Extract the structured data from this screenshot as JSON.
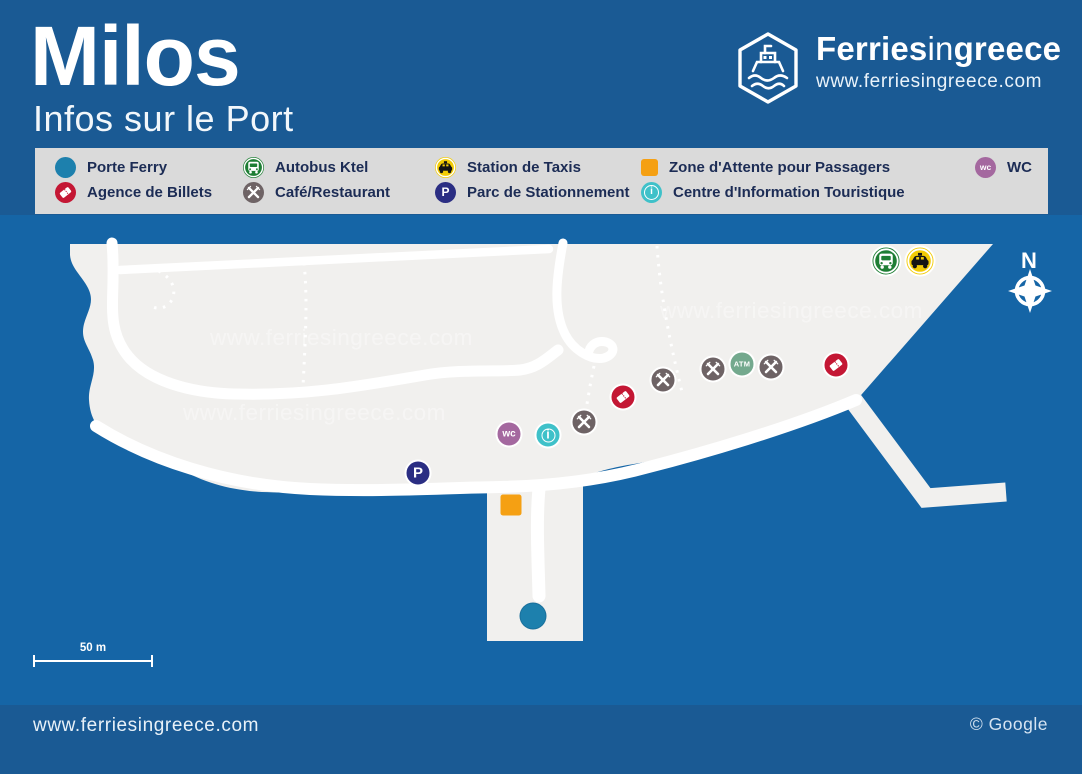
{
  "page": {
    "bg_blue": "#1A5A94",
    "sea_blue": "#1565A6",
    "land_gray": "#F1F0EE",
    "road_white": "#FFFFFF",
    "legend_bg": "#DADADA",
    "legend_text": "#1C2C55"
  },
  "header": {
    "title": "Milos",
    "subtitle": "Infos sur le Port",
    "brand": {
      "part1": "Ferries",
      "part2": "in",
      "part3": "greece",
      "url": "www.ferriesingreece.com"
    }
  },
  "legend": {
    "items": [
      {
        "type": "ferry",
        "label": "Porte Ferry",
        "color": "#1D80AD",
        "row": 0,
        "col": 0
      },
      {
        "type": "bus",
        "label": "Autobus Ktel",
        "color": "#1E7E34",
        "row": 0,
        "col": 1
      },
      {
        "type": "taxi",
        "label": "Station de Taxis",
        "color": "#F2CB05",
        "row": 0,
        "col": 2
      },
      {
        "type": "waiting",
        "label": "Zone d'Attente pour Passagers",
        "color": "#F5A013",
        "shape": "square",
        "row": 0,
        "col": 3
      },
      {
        "type": "wc",
        "label": "WC",
        "color": "#A4689F",
        "text": "wc",
        "row": 0,
        "col": 4
      },
      {
        "type": "ticket",
        "label": "Agence de Billets",
        "color": "#C41734",
        "row": 1,
        "col": 0
      },
      {
        "type": "cafe",
        "label": "Café/Restaurant",
        "color": "#6E6365",
        "row": 1,
        "col": 1
      },
      {
        "type": "parking",
        "label": "Parc de Stationnement",
        "color": "#2B2E83",
        "text": "P",
        "row": 1,
        "col": 2
      },
      {
        "type": "info",
        "label": "Centre d'Information Touristique",
        "color": "#3FC1C9",
        "text": "i",
        "row": 1,
        "col": 3
      }
    ]
  },
  "map": {
    "watermark": "www.ferriesingreece.com",
    "compass_label": "N",
    "scale_label": "50 m",
    "markers": [
      {
        "type": "bus",
        "x": 886,
        "y": 261,
        "color": "#1E7E34"
      },
      {
        "type": "taxi",
        "x": 920,
        "y": 261,
        "color": "#F2CB05"
      },
      {
        "type": "ticket",
        "x": 836,
        "y": 365,
        "color": "#C41734"
      },
      {
        "type": "cafe",
        "x": 771,
        "y": 367,
        "color": "#6E6365"
      },
      {
        "type": "atm",
        "x": 742,
        "y": 364,
        "color": "#74A98E",
        "text": "ATM"
      },
      {
        "type": "cafe",
        "x": 713,
        "y": 369,
        "color": "#6E6365"
      },
      {
        "type": "cafe",
        "x": 663,
        "y": 380,
        "color": "#6E6365"
      },
      {
        "type": "ticket",
        "x": 623,
        "y": 397,
        "color": "#C41734"
      },
      {
        "type": "cafe",
        "x": 584,
        "y": 422,
        "color": "#6E6365"
      },
      {
        "type": "info",
        "x": 548,
        "y": 435,
        "color": "#3FC1C9",
        "text": "i"
      },
      {
        "type": "wc",
        "x": 509,
        "y": 434,
        "color": "#A4689F",
        "text": "wc"
      },
      {
        "type": "parking",
        "x": 418,
        "y": 473,
        "color": "#2B2E83",
        "text": "P"
      },
      {
        "type": "waiting",
        "x": 511,
        "y": 505,
        "color": "#F5A013"
      },
      {
        "type": "ferry",
        "x": 533,
        "y": 616,
        "color": "#1D80AD"
      }
    ]
  },
  "footer": {
    "url": "www.ferriesingreece.com",
    "credit": "© Google"
  }
}
